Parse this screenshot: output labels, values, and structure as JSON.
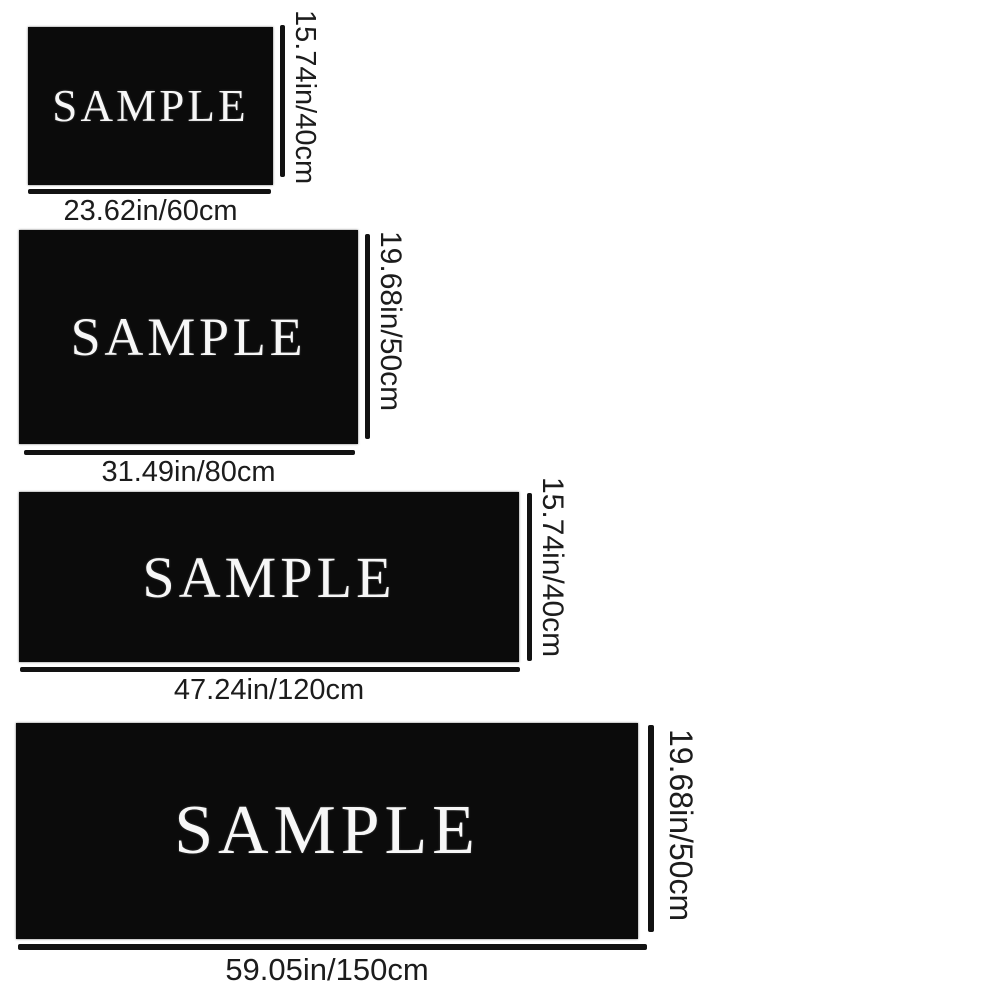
{
  "image_type": "product-size-chart",
  "sample_text": "SAMPLE",
  "colors": {
    "background": "#ffffff",
    "swatch_fill": "#0b0b0b",
    "sample_text": "#f7f7f7",
    "label_text": "#1c1c1c",
    "measure_line": "#121212"
  },
  "sizes": [
    {
      "width_label": "23.62in/60cm",
      "height_label": "15.74in/40cm"
    },
    {
      "width_label": "31.49in/80cm",
      "height_label": "19.68in/50cm"
    },
    {
      "width_label": "47.24in/120cm",
      "height_label": "15.74in/40cm"
    },
    {
      "width_label": "59.05in/150cm",
      "height_label": "19.68in/50cm"
    }
  ]
}
